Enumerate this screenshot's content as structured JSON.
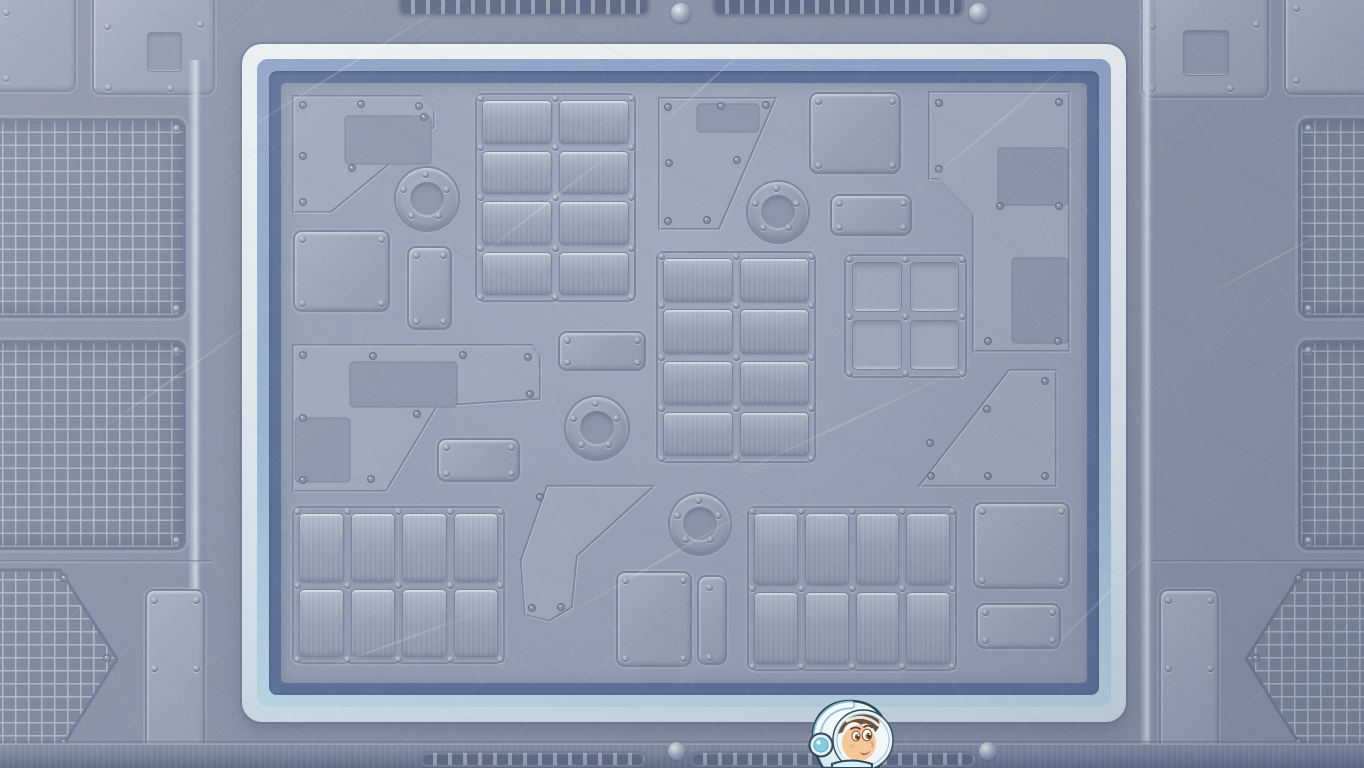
{
  "scene": {
    "kind": "game-screenshot",
    "setting": "spaceship-metal-floor-arena",
    "width": 1364,
    "height": 768,
    "visible_text": "none"
  },
  "palette": {
    "background": "#8b94a8",
    "panel_fill": "#9fa9bc",
    "panel_recess": "#8f99ad",
    "groove": "#7b86a0",
    "mesh_bg": "#7e899d",
    "mesh_line": "#b6c0cf",
    "arena_white": "#e7edf1",
    "arena_ice_blue": "#b9d4e2",
    "arena_periwinkle": "#8fa3c6",
    "arena_dark_blue": "#5e7199",
    "arena_floor": "#99a3b7",
    "rivet": "#8b95a8",
    "dome_rivet": "#9aa4b6",
    "character_helmet": "#ecf5f9",
    "character_helmet_shade": "#c6e2ee",
    "character_earcup": "#86cbe0",
    "character_skin": "#f3c190",
    "character_hair": "#5e4026",
    "character_outline": "#2c4a5a"
  },
  "arena": {
    "x": 242,
    "y": 44,
    "w": 884,
    "h": 678,
    "radius": 20,
    "band_white": 15,
    "band_light": 12,
    "band_dark": 12
  },
  "floor_items": [
    {
      "kind": "poly",
      "name": "angled-panel",
      "points": [
        [
          293,
          96
        ],
        [
          421,
          96
        ],
        [
          434,
          110
        ],
        [
          434,
          127
        ],
        [
          331,
          212
        ],
        [
          293,
          212
        ]
      ],
      "rivets": [
        [
          303,
          105
        ],
        [
          361,
          104
        ],
        [
          419,
          106
        ],
        [
          303,
          156
        ],
        [
          303,
          202
        ],
        [
          352,
          168
        ],
        [
          424,
          117
        ]
      ],
      "inner": [
        [
          345,
          116,
          86,
          48
        ]
      ]
    },
    {
      "kind": "port",
      "name": "porthole",
      "cx": 427,
      "cy": 199,
      "r": 31
    },
    {
      "kind": "rect",
      "name": "panel",
      "x": 293,
      "y": 230,
      "w": 97,
      "h": 82,
      "rivets": "corners"
    },
    {
      "kind": "rect",
      "name": "panel",
      "x": 407,
      "y": 246,
      "w": 45,
      "h": 84,
      "rivets": "corners"
    },
    {
      "kind": "plates",
      "name": "plate-grid",
      "x": 475,
      "y": 93,
      "w": 161,
      "h": 209,
      "cols": 2,
      "rows": 4
    },
    {
      "kind": "poly",
      "name": "angled-panel",
      "points": [
        [
          659,
          98
        ],
        [
          776,
          98
        ],
        [
          719,
          229
        ],
        [
          659,
          229
        ]
      ],
      "rivets": [
        [
          668,
          107
        ],
        [
          721,
          106
        ],
        [
          766,
          105
        ],
        [
          669,
          163
        ],
        [
          737,
          160
        ],
        [
          668,
          221
        ],
        [
          707,
          220
        ]
      ],
      "inner": [
        [
          697,
          104,
          62,
          28
        ]
      ]
    },
    {
      "kind": "rect",
      "name": "panel",
      "x": 809,
      "y": 92,
      "w": 92,
      "h": 82,
      "rivets": "corners"
    },
    {
      "kind": "port",
      "name": "porthole",
      "cx": 778,
      "cy": 212,
      "r": 30
    },
    {
      "kind": "rect",
      "name": "panel",
      "x": 830,
      "y": 194,
      "w": 82,
      "h": 42,
      "rivets": "corners"
    },
    {
      "kind": "poly",
      "name": "step-panel",
      "points": [
        [
          929,
          92
        ],
        [
          1069,
          92
        ],
        [
          1069,
          351
        ],
        [
          973,
          351
        ],
        [
          973,
          214
        ],
        [
          938,
          179
        ],
        [
          929,
          179
        ]
      ],
      "rivets": [
        [
          939,
          103
        ],
        [
          1059,
          102
        ],
        [
          939,
          169
        ],
        [
          1000,
          206
        ],
        [
          1059,
          206
        ],
        [
          988,
          341
        ],
        [
          1058,
          341
        ]
      ],
      "inner": [
        [
          998,
          148,
          70,
          57
        ],
        [
          1012,
          258,
          56,
          85
        ]
      ]
    },
    {
      "kind": "windows",
      "name": "window-grid",
      "x": 844,
      "y": 254,
      "w": 123,
      "h": 124,
      "cols": 2,
      "rows": 2
    },
    {
      "kind": "plates",
      "name": "plate-grid",
      "x": 656,
      "y": 251,
      "w": 160,
      "h": 212,
      "cols": 2,
      "rows": 4
    },
    {
      "kind": "poly",
      "name": "step-panel",
      "points": [
        [
          293,
          345
        ],
        [
          532,
          345
        ],
        [
          540,
          355
        ],
        [
          540,
          399
        ],
        [
          437,
          406
        ],
        [
          386,
          491
        ],
        [
          293,
          491
        ]
      ],
      "rivets": [
        [
          303,
          355
        ],
        [
          373,
          356
        ],
        [
          463,
          355
        ],
        [
          528,
          357
        ],
        [
          303,
          418
        ],
        [
          417,
          414
        ],
        [
          303,
          480
        ],
        [
          371,
          479
        ],
        [
          530,
          394
        ]
      ],
      "inner": [
        [
          350,
          362,
          107,
          45
        ],
        [
          295,
          418,
          55,
          64
        ]
      ]
    },
    {
      "kind": "rect",
      "name": "panel",
      "x": 437,
      "y": 438,
      "w": 83,
      "h": 44,
      "rivets": "corners"
    },
    {
      "kind": "port",
      "name": "porthole",
      "cx": 597,
      "cy": 428,
      "r": 31
    },
    {
      "kind": "rect",
      "name": "panel",
      "x": 558,
      "y": 331,
      "w": 88,
      "h": 40,
      "rivets": "corners"
    },
    {
      "kind": "poly",
      "name": "arrow-panel",
      "points": [
        [
          547,
          486
        ],
        [
          654,
          486
        ],
        [
          577,
          556
        ],
        [
          572,
          607
        ],
        [
          549,
          621
        ],
        [
          525,
          615
        ],
        [
          521,
          560
        ]
      ],
      "rivets": [
        [
          532,
          608
        ],
        [
          561,
          607
        ],
        [
          540,
          497
        ]
      ]
    },
    {
      "kind": "plates",
      "name": "plate-grid",
      "x": 292,
      "y": 506,
      "w": 213,
      "h": 158,
      "cols": 4,
      "rows": 2
    },
    {
      "kind": "port",
      "name": "porthole",
      "cx": 700,
      "cy": 524,
      "r": 30
    },
    {
      "kind": "rect",
      "name": "panel",
      "x": 616,
      "y": 571,
      "w": 76,
      "h": 96,
      "rivets": "corners"
    },
    {
      "kind": "rect",
      "name": "panel",
      "x": 697,
      "y": 575,
      "w": 30,
      "h": 90,
      "rivets": [
        [
          709,
          587
        ],
        [
          709,
          657
        ]
      ]
    },
    {
      "kind": "plates",
      "name": "plate-grid",
      "x": 747,
      "y": 506,
      "w": 210,
      "h": 165,
      "cols": 4,
      "rows": 2
    },
    {
      "kind": "poly",
      "name": "wedge-panel",
      "points": [
        [
          1009,
          370
        ],
        [
          1056,
          370
        ],
        [
          1056,
          486
        ],
        [
          919,
          486
        ]
      ],
      "rivets": [
        [
          1045,
          381
        ],
        [
          987,
          409
        ],
        [
          930,
          443
        ],
        [
          931,
          476
        ],
        [
          988,
          476
        ],
        [
          1045,
          476
        ]
      ]
    },
    {
      "kind": "rect",
      "name": "panel",
      "x": 973,
      "y": 502,
      "w": 97,
      "h": 87,
      "rivets": "corners"
    },
    {
      "kind": "rect",
      "name": "panel",
      "x": 976,
      "y": 603,
      "w": 85,
      "h": 46,
      "rivets": "corners"
    }
  ],
  "background_items": [
    {
      "kind": "rect",
      "name": "panel",
      "x": -40,
      "y": -30,
      "w": 116,
      "h": 122,
      "rivets": [
        [
          6,
          12
        ],
        [
          6,
          78
        ]
      ]
    },
    {
      "kind": "rect",
      "name": "panel-notched",
      "x": 92,
      "y": -12,
      "w": 123,
      "h": 107,
      "rivets": [
        [
          107,
          26
        ],
        [
          200,
          24
        ],
        [
          108,
          87
        ],
        [
          170,
          88
        ]
      ],
      "inner": [
        [
          147,
          32,
          35,
          40
        ]
      ]
    },
    {
      "kind": "mesh",
      "name": "vent-grid-panel",
      "x": -40,
      "y": 118,
      "w": 226,
      "h": 200,
      "rivets": [
        [
          176,
          128
        ],
        [
          176,
          308
        ]
      ]
    },
    {
      "kind": "mesh",
      "name": "vent-grid-panel",
      "x": -40,
      "y": 340,
      "w": 226,
      "h": 210,
      "rivets": [
        [
          176,
          350
        ],
        [
          176,
          540
        ]
      ]
    },
    {
      "kind": "strip-v",
      "name": "panel-edge-highlight",
      "x": 188,
      "y": 60,
      "w": 17,
      "h": 708
    },
    {
      "kind": "hexmesh",
      "name": "hex-grid-panel",
      "points": [
        [
          -20,
          570
        ],
        [
          60,
          570
        ],
        [
          117,
          659
        ],
        [
          60,
          750
        ],
        [
          -20,
          750
        ]
      ],
      "rivets": [
        [
          64,
          578
        ],
        [
          107,
          658
        ],
        [
          64,
          742
        ]
      ]
    },
    {
      "kind": "rect",
      "name": "panel",
      "x": 145,
      "y": 589,
      "w": 60,
      "h": 196,
      "rivets": [
        [
          154,
          600
        ],
        [
          196,
          600
        ],
        [
          154,
          668
        ],
        [
          196,
          668
        ]
      ]
    },
    {
      "kind": "rect",
      "name": "panel-notched",
      "x": 1141,
      "y": -12,
      "w": 128,
      "h": 110,
      "rivets": [
        [
          1152,
          26
        ],
        [
          1256,
          24
        ],
        [
          1152,
          88
        ],
        [
          1230,
          88
        ]
      ],
      "inner": [
        [
          1183,
          30,
          46,
          46
        ]
      ]
    },
    {
      "kind": "rect",
      "name": "panel",
      "x": 1284,
      "y": -25,
      "w": 130,
      "h": 120,
      "rivets": [
        [
          1296,
          8
        ],
        [
          1296,
          80
        ]
      ]
    },
    {
      "kind": "mesh",
      "name": "vent-grid-panel",
      "x": 1298,
      "y": 118,
      "w": 140,
      "h": 200,
      "rivets": [
        [
          1308,
          128
        ],
        [
          1308,
          308
        ]
      ]
    },
    {
      "kind": "mesh",
      "name": "vent-grid-panel",
      "x": 1298,
      "y": 340,
      "w": 140,
      "h": 210,
      "rivets": [
        [
          1308,
          350
        ],
        [
          1308,
          540
        ]
      ]
    },
    {
      "kind": "strip-v",
      "name": "panel-edge-highlight",
      "x": 1140,
      "y": 0,
      "w": 16,
      "h": 768
    },
    {
      "kind": "hexmesh",
      "name": "hex-grid-panel",
      "points": [
        [
          1384,
          570
        ],
        [
          1303,
          570
        ],
        [
          1246,
          659
        ],
        [
          1303,
          750
        ],
        [
          1384,
          750
        ]
      ],
      "rivets": [
        [
          1299,
          578
        ],
        [
          1256,
          658
        ],
        [
          1299,
          742
        ]
      ]
    },
    {
      "kind": "rect",
      "name": "panel",
      "x": 1159,
      "y": 589,
      "w": 60,
      "h": 196,
      "rivets": [
        [
          1168,
          600
        ],
        [
          1210,
          600
        ],
        [
          1168,
          668
        ],
        [
          1210,
          668
        ]
      ]
    },
    {
      "kind": "vent",
      "name": "vent-strip",
      "x": 398,
      "y": -16,
      "w": 252,
      "h": 32
    },
    {
      "kind": "vent",
      "name": "vent-strip",
      "x": 712,
      "y": -16,
      "w": 252,
      "h": 32
    },
    {
      "kind": "dome",
      "name": "dome-rivet",
      "cx": 681,
      "cy": 13,
      "r": 10
    },
    {
      "kind": "dome",
      "name": "dome-rivet",
      "cx": 979,
      "cy": 13,
      "r": 10
    },
    {
      "kind": "band",
      "name": "lower-wall-band",
      "x": 0,
      "y": 744,
      "w": 1364,
      "h": 24
    },
    {
      "kind": "groove-h",
      "name": "floor-seam",
      "x": 0,
      "y": 741,
      "w": 1364,
      "h": 4
    },
    {
      "kind": "vent",
      "name": "vent-strip",
      "x": 420,
      "y": 751,
      "w": 226,
      "h": 16
    },
    {
      "kind": "vent",
      "name": "vent-strip",
      "x": 690,
      "y": 751,
      "w": 286,
      "h": 16
    },
    {
      "kind": "dome",
      "name": "dome-rivet",
      "cx": 677,
      "cy": 751,
      "r": 9
    },
    {
      "kind": "dome",
      "name": "dome-rivet",
      "cx": 988,
      "cy": 751,
      "r": 9
    },
    {
      "kind": "groove-h",
      "name": "panel-seam",
      "x": 0,
      "y": 560,
      "w": 212,
      "h": 3
    },
    {
      "kind": "groove-h",
      "name": "panel-seam",
      "x": 1152,
      "y": 560,
      "w": 212,
      "h": 3
    }
  ],
  "scratches": [
    {
      "x": 180,
      "y": 70,
      "len": 320,
      "angle": -32
    },
    {
      "x": 420,
      "y": 200,
      "len": 260,
      "angle": -38
    },
    {
      "x": 700,
      "y": 420,
      "len": 300,
      "angle": -25
    },
    {
      "x": 880,
      "y": 120,
      "len": 240,
      "angle": -40
    },
    {
      "x": 520,
      "y": 560,
      "len": 280,
      "angle": -30
    },
    {
      "x": 1000,
      "y": 600,
      "len": 200,
      "angle": -45
    },
    {
      "x": 60,
      "y": 380,
      "len": 220,
      "angle": -35
    },
    {
      "x": 1180,
      "y": 260,
      "len": 180,
      "angle": -28
    },
    {
      "x": 300,
      "y": 640,
      "len": 200,
      "angle": -20
    },
    {
      "x": 620,
      "y": 80,
      "len": 180,
      "angle": -42
    }
  ],
  "character": {
    "name": "astronaut-kid",
    "x": 804,
    "y": 698,
    "w": 92,
    "h": 70,
    "facing": "right"
  }
}
